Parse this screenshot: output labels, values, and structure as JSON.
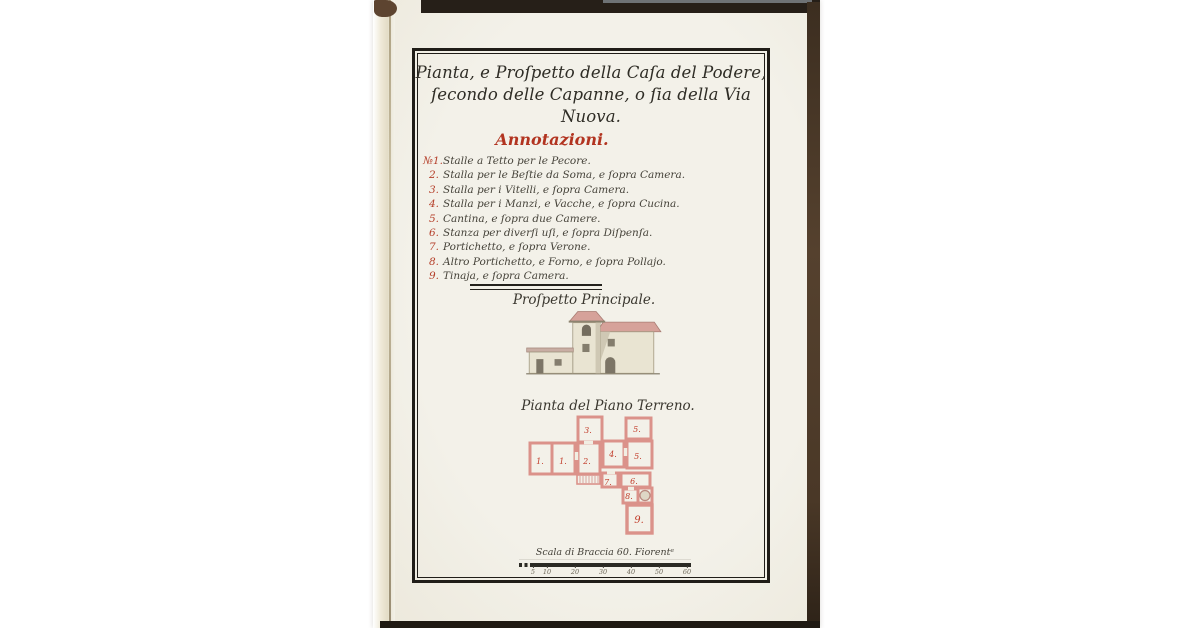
{
  "plate": {
    "title_line1": "Pianta, e Proſpetto della Caſa del Podere,",
    "title_line2": "ſecondo delle Capanne, o ſia della Via Nuova.",
    "annotations_heading": "Annotazioni.",
    "annotations": [
      {
        "num": "№1.",
        "text": "Stalle a Tetto per le Pecore."
      },
      {
        "num": "2.",
        "text": "Stalla per le Beſtie da Soma, e ſopra Camera."
      },
      {
        "num": "3.",
        "text": "Stalla per i Vitelli, e ſopra Camera."
      },
      {
        "num": "4.",
        "text": "Stalla per i Manzi, e Vacche, e ſopra Cucina."
      },
      {
        "num": "5.",
        "text": "Cantina, e ſopra due Camere."
      },
      {
        "num": "6.",
        "text": "Stanza per diverſi uſi, e ſopra Diſpenſa."
      },
      {
        "num": "7.",
        "text": "Portichetto, e ſopra Verone."
      },
      {
        "num": "8.",
        "text": "Altro Portichetto, e Forno, e ſopra Pollajo."
      },
      {
        "num": "9.",
        "text": "Tinaja, e ſopra Camera."
      }
    ],
    "elevation_label": "Proſpetto Principale.",
    "plan_label": "Pianta del Piano Terreno.",
    "plan_room_numbers": [
      "1.",
      "1.",
      "2.",
      "3.",
      "4.",
      "5.",
      "5.",
      "6.",
      "7.",
      "8.",
      "9."
    ],
    "scale_label": "Scala di Braccia 60. Fiorentᵉ",
    "scale_ticks": [
      "5",
      "10",
      "20",
      "30",
      "40",
      "50",
      "60"
    ]
  },
  "colors": {
    "red_ink": "#b23420",
    "black_ink": "#35322a",
    "paper": "#f1efe6",
    "plan_wall_pink": "#db928a",
    "roof_pink": "#d6a29a"
  }
}
